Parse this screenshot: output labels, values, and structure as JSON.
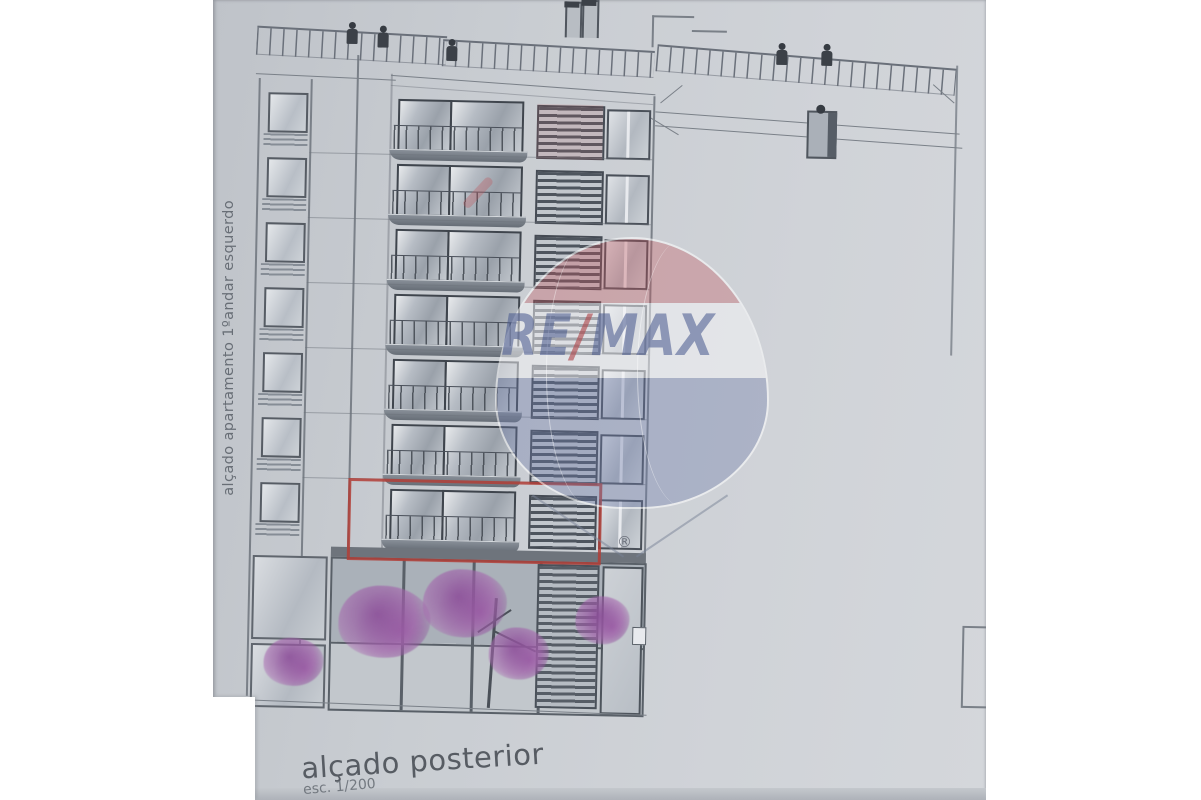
{
  "scene": {
    "paper_color": "#c9cdd2",
    "background_color": "#ffffff",
    "line_color": "#70767e",
    "shadow_strip_color": "#b4b8be"
  },
  "labels": {
    "side_vertical": "alçado apartamento 1ºandar esquerdo",
    "title": "alçado posterior",
    "scale": "esc. 1/200"
  },
  "watermark": {
    "brand_left": "RE",
    "brand_slash": "/",
    "brand_right": "MAX",
    "registered": "®",
    "balloon_red": "#c3555a",
    "balloon_blue": "#6c7aa8",
    "text_color": "#46558c"
  },
  "highlight": {
    "border_color": "#b23e37"
  },
  "building": {
    "floor_count": 7,
    "floor_top_start": 93,
    "floor_pitch": 65,
    "vegetation_color_outer": "rgba(168,104,176,0.55)",
    "vegetation_color_inner": "rgba(141,79,154,0.85)",
    "figures": [
      {
        "x": 132,
        "y": 27
      },
      {
        "x": 163,
        "y": 30
      },
      {
        "x": 232,
        "y": 42
      },
      {
        "x": 562,
        "y": 39
      },
      {
        "x": 607,
        "y": 39
      }
    ],
    "vegetation": [
      {
        "x": 92,
        "y": 668,
        "rx": 30,
        "ry": 24
      },
      {
        "x": 182,
        "y": 626,
        "rx": 46,
        "ry": 36
      },
      {
        "x": 262,
        "y": 606,
        "rx": 42,
        "ry": 34
      },
      {
        "x": 317,
        "y": 655,
        "rx": 30,
        "ry": 26
      },
      {
        "x": 400,
        "y": 620,
        "rx": 27,
        "ry": 24
      }
    ]
  }
}
